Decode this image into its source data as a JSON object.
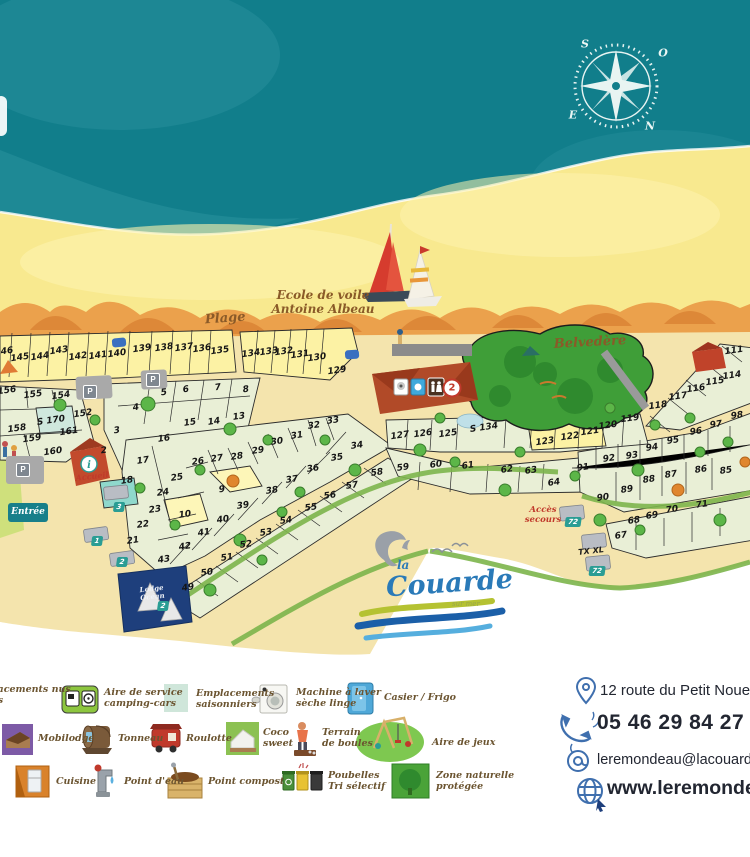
{
  "map": {
    "labels": {
      "plage": "Plage",
      "ecole1": "Ecole de voile",
      "ecole2": "Antoine Albeau",
      "belvedere": "Belvedère",
      "acces1": "Accès",
      "acces2": "secours",
      "entree": "Entrée",
      "accueil": "Accueil",
      "lodge1": "Lodge",
      "lodge2": "Océan"
    },
    "compass_letters": [
      {
        "l": "S",
        "x": 585,
        "y": 44
      },
      {
        "l": "O",
        "x": 663,
        "y": 53
      },
      {
        "l": "E",
        "x": 573,
        "y": 115
      },
      {
        "l": "N",
        "x": 650,
        "y": 126
      }
    ],
    "parking_label": "P",
    "parking": [
      [
        90,
        392
      ],
      [
        153,
        380
      ],
      [
        23,
        470
      ]
    ],
    "markers": [
      {
        "t": "tag",
        "l": "1",
        "x": 97,
        "y": 541
      },
      {
        "t": "tag",
        "l": "2",
        "x": 122,
        "y": 562
      },
      {
        "t": "tag",
        "l": "3",
        "x": 119,
        "y": 507
      },
      {
        "t": "tag",
        "l": "2",
        "x": 163,
        "y": 606
      },
      {
        "t": "tag",
        "l": "72",
        "x": 573,
        "y": 522
      },
      {
        "t": "tag",
        "l": "72",
        "x": 597,
        "y": 571
      },
      {
        "t": "text",
        "l": "TX XL",
        "x": 591,
        "y": 551
      },
      {
        "t": "badge",
        "l": "2",
        "x": 452,
        "y": 388
      }
    ],
    "plots": [
      [
        "146",
        4,
        352
      ],
      [
        "145",
        20,
        358
      ],
      [
        "144",
        40,
        357
      ],
      [
        "143",
        59,
        351
      ],
      [
        "142",
        78,
        357
      ],
      [
        "141",
        98,
        356
      ],
      [
        "140",
        117,
        354
      ],
      [
        "139",
        142,
        349
      ],
      [
        "138",
        164,
        348
      ],
      [
        "137",
        184,
        348
      ],
      [
        "136",
        202,
        349
      ],
      [
        "135",
        220,
        351
      ],
      [
        "134",
        251,
        354
      ],
      [
        "133",
        269,
        352
      ],
      [
        "132",
        284,
        352
      ],
      [
        "131",
        300,
        355
      ],
      [
        "130",
        317,
        358
      ],
      [
        "129",
        337,
        371
      ],
      [
        "156",
        7,
        391
      ],
      [
        "155",
        33,
        395
      ],
      [
        "154",
        61,
        396
      ],
      [
        "152",
        83,
        414
      ],
      [
        "S 170",
        51,
        421
      ],
      [
        "161",
        69,
        432
      ],
      [
        "158",
        17,
        429
      ],
      [
        "159",
        32,
        439
      ],
      [
        "160",
        53,
        452
      ],
      [
        "2",
        104,
        451
      ],
      [
        "3",
        117,
        431
      ],
      [
        "4",
        136,
        408
      ],
      [
        "5",
        164,
        393
      ],
      [
        "6",
        186,
        390
      ],
      [
        "7",
        218,
        388
      ],
      [
        "8",
        246,
        390
      ],
      [
        "13",
        239,
        417
      ],
      [
        "14",
        214,
        422
      ],
      [
        "15",
        190,
        423
      ],
      [
        "16",
        164,
        439
      ],
      [
        "17",
        143,
        461
      ],
      [
        "18",
        127,
        481
      ],
      [
        "21",
        133,
        541
      ],
      [
        "22",
        143,
        525
      ],
      [
        "23",
        155,
        510
      ],
      [
        "24",
        163,
        493
      ],
      [
        "25",
        177,
        478
      ],
      [
        "26",
        198,
        462
      ],
      [
        "27",
        217,
        459
      ],
      [
        "28",
        237,
        457
      ],
      [
        "29",
        258,
        451
      ],
      [
        "30",
        277,
        442
      ],
      [
        "31",
        297,
        436
      ],
      [
        "32",
        314,
        426
      ],
      [
        "33",
        333,
        421
      ],
      [
        "34",
        357,
        446
      ],
      [
        "35",
        337,
        458
      ],
      [
        "36",
        313,
        469
      ],
      [
        "37",
        292,
        480
      ],
      [
        "38",
        272,
        491
      ],
      [
        "39",
        243,
        506
      ],
      [
        "40",
        223,
        520
      ],
      [
        "41",
        204,
        533
      ],
      [
        "42",
        185,
        547
      ],
      [
        "43",
        164,
        560
      ],
      [
        "9",
        222,
        490
      ],
      [
        "10",
        185,
        515
      ],
      [
        "49",
        188,
        588
      ],
      [
        "50",
        207,
        573
      ],
      [
        "51",
        227,
        558
      ],
      [
        "52",
        246,
        545
      ],
      [
        "53",
        266,
        533
      ],
      [
        "54",
        286,
        521
      ],
      [
        "55",
        311,
        508
      ],
      [
        "56",
        330,
        496
      ],
      [
        "57",
        352,
        486
      ],
      [
        "58",
        377,
        473
      ],
      [
        "59",
        403,
        468
      ],
      [
        "60",
        436,
        465
      ],
      [
        "61",
        468,
        466
      ],
      [
        "62",
        507,
        470
      ],
      [
        "63",
        531,
        471
      ],
      [
        "64",
        554,
        483
      ],
      [
        "67",
        621,
        536
      ],
      [
        "68",
        634,
        521
      ],
      [
        "69",
        652,
        516
      ],
      [
        "70",
        672,
        510
      ],
      [
        "71",
        702,
        505
      ],
      [
        "85",
        726,
        471
      ],
      [
        "86",
        701,
        470
      ],
      [
        "87",
        671,
        475
      ],
      [
        "88",
        649,
        480
      ],
      [
        "89",
        627,
        490
      ],
      [
        "90",
        603,
        498
      ],
      [
        "91",
        583,
        468
      ],
      [
        "92",
        609,
        459
      ],
      [
        "93",
        632,
        456
      ],
      [
        "94",
        652,
        448
      ],
      [
        "95",
        673,
        441
      ],
      [
        "96",
        696,
        432
      ],
      [
        "97",
        716,
        425
      ],
      [
        "98",
        737,
        416
      ],
      [
        "111",
        734,
        351
      ],
      [
        "114",
        732,
        376
      ],
      [
        "115",
        715,
        382
      ],
      [
        "116",
        696,
        389
      ],
      [
        "117",
        678,
        397
      ],
      [
        "118",
        658,
        406
      ],
      [
        "119",
        630,
        419
      ],
      [
        "120",
        608,
        426
      ],
      [
        "121",
        590,
        432
      ],
      [
        "122",
        570,
        437
      ],
      [
        "123",
        545,
        442
      ],
      [
        "125",
        448,
        434
      ],
      [
        "126",
        423,
        434
      ],
      [
        "127",
        400,
        436
      ],
      [
        "S 134",
        484,
        428
      ]
    ]
  },
  "logo": {
    "la": "la",
    "name": "Couarde",
    "subtitle": "sur mer"
  },
  "legend": {
    "items": [
      {
        "icon": "tent-pitch-icon",
        "label": "Emplacements nus\ntentes"
      },
      {
        "icon": "camper-service-icon",
        "label": "Aire de service\ncamping-cars"
      },
      {
        "icon": "seasonal-pitch-icon",
        "label": "Emplacements\nsaisonniers"
      },
      {
        "icon": "washing-machine-icon",
        "label": "Machine à laver\nsèche linge"
      },
      {
        "icon": "locker-fridge-icon",
        "label": "Casier / Frigo"
      },
      {
        "icon": "mobilodge-icon",
        "label": "Mobilodge"
      },
      {
        "icon": "barrel-icon",
        "label": "Tonneau"
      },
      {
        "icon": "wagon-icon",
        "label": "Roulotte"
      },
      {
        "icon": "coco-sweet-icon",
        "label": "Coco\nsweet"
      },
      {
        "icon": "petanque-icon",
        "label": "Terrain\nde boules"
      },
      {
        "icon": "playground-icon",
        "label": "Aire de jeux"
      },
      {
        "icon": "kitchen-icon",
        "label": "Cuisine"
      },
      {
        "icon": "water-point-icon",
        "label": "Point d'eau"
      },
      {
        "icon": "compost-icon",
        "label": "Point compost"
      },
      {
        "icon": "recycle-bins-icon",
        "label": "Poubelles\nTri sélectif"
      },
      {
        "icon": "protected-zone-icon",
        "label": "Zone naturelle\nprotégée"
      }
    ]
  },
  "contact": {
    "address": "12 route du Petit Noue",
    "phone": "05 46 29 84 27",
    "email": "leremondeau@lacouard",
    "website": "www.leremonde"
  }
}
